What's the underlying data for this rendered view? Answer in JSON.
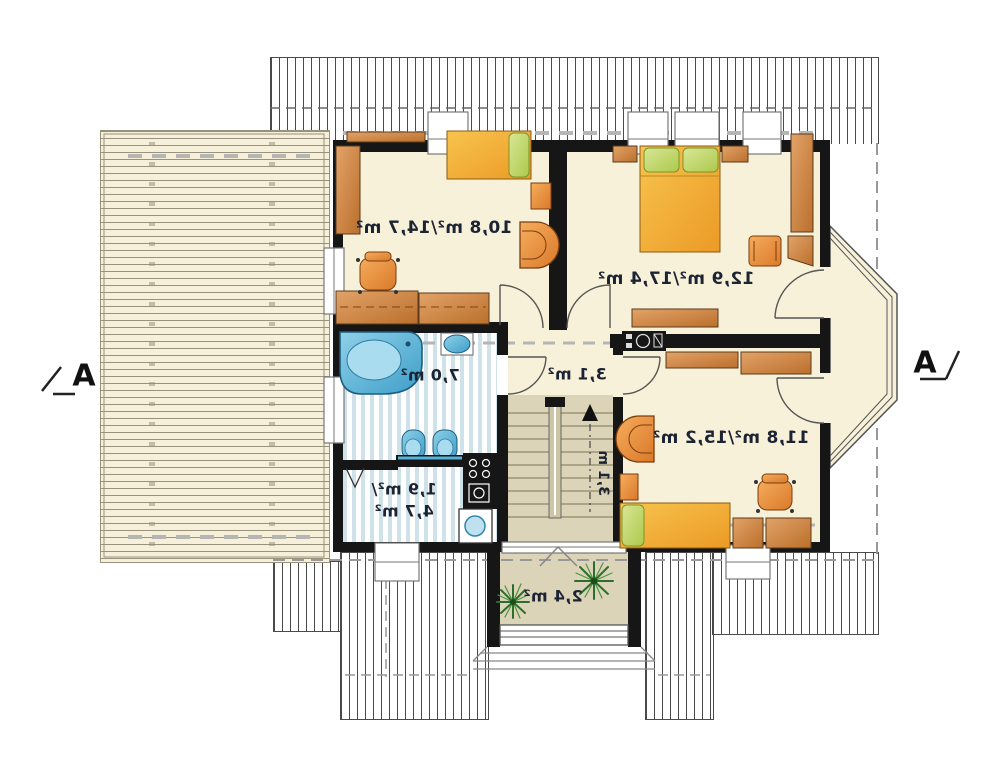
{
  "plan": {
    "type": "attic-floor-plan",
    "text_mirrored": true,
    "labels": {
      "room_top_left": "10,8 m²/14,7 m²",
      "room_top_right": "12,9 m²/17,4 m²",
      "room_bottom_right": "11,8 m²/15,2 m²",
      "bathroom": "7,0 m²",
      "laundry_line1": "1,9 m²/",
      "laundry_line2": "4,7 m²",
      "hall": "3,1 m²",
      "stairs_width": "3,1 m",
      "balcony": "2,4 m²",
      "section_left": "A",
      "section_right": "A"
    }
  },
  "colors": {
    "floor": "#F8F1DA",
    "wall": "#161616",
    "roofline": "#4a4a4a",
    "terrace": "#F6EFD9",
    "terraceline": "#98917c",
    "stripe": "#cfe2ea",
    "beige": "#DCD4B8",
    "ink": "#1c2333",
    "dash": "#9a9a9a",
    "plant": "#2d6e2d",
    "furniture_orange": "#E8872D",
    "furniture_brown": "#CE8A45",
    "bed_yellow": "#F2A93B",
    "pillow_green": "#C4D96A",
    "fixture_blue": "#56B4DC"
  }
}
